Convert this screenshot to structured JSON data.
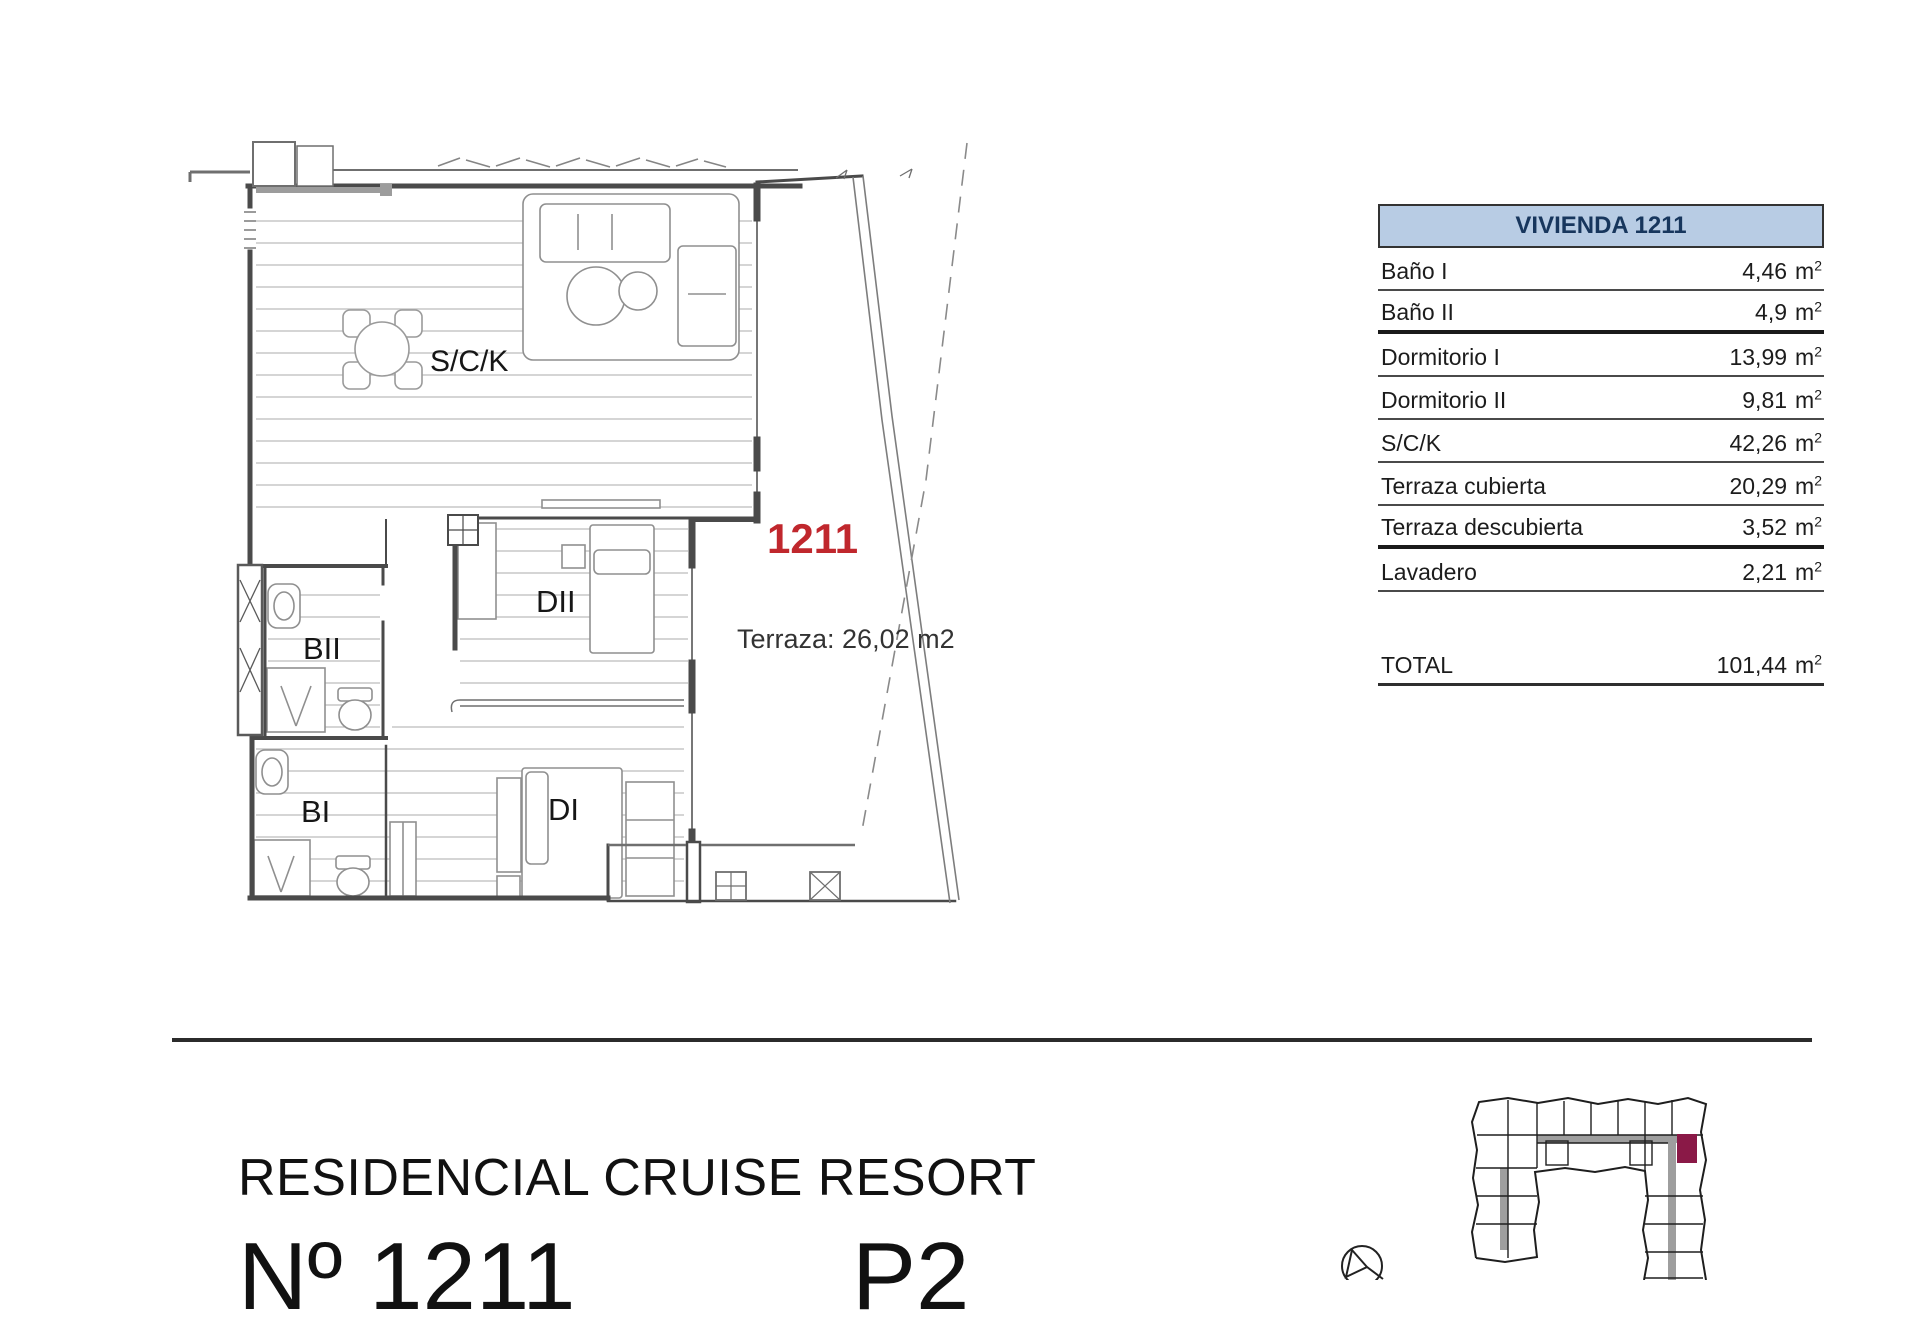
{
  "floor_plan": {
    "unit_number": "1211",
    "terrace_note": "Terraza: 26,02 m2",
    "room_labels": {
      "living": "S/C/K",
      "bedroom2": "DII",
      "bath2": "BII",
      "bath1": "BI",
      "bedroom1": "DI"
    }
  },
  "area_table": {
    "header": "VIVIENDA 1211",
    "rows": [
      {
        "label": "Baño I",
        "value": "4,46",
        "unit": "m",
        "sup": "2"
      },
      {
        "label": "Baño II",
        "value": "4,9",
        "unit": "m",
        "sup": "2"
      },
      {
        "label": "Dormitorio I",
        "value": "13,99",
        "unit": "m",
        "sup": "2"
      },
      {
        "label": "Dormitorio II",
        "value": "9,81",
        "unit": "m",
        "sup": "2"
      },
      {
        "label": "S/C/K",
        "value": "42,26",
        "unit": "m",
        "sup": "2"
      },
      {
        "label": "Terraza cubierta",
        "value": "20,29",
        "unit": "m",
        "sup": "2"
      },
      {
        "label": "Terraza descubierta",
        "value": "3,52",
        "unit": "m",
        "sup": "2"
      },
      {
        "label": "Lavadero",
        "value": "2,21",
        "unit": "m",
        "sup": "2"
      }
    ],
    "total": {
      "label": "TOTAL",
      "value": "101,44",
      "unit": "m",
      "sup": "2"
    }
  },
  "footer": {
    "project_name": "RESIDENCIAL CRUISE RESORT",
    "unit_label": "Nº 1211",
    "floor_label": "P2"
  },
  "colors": {
    "unit_number_red": "#c0272d",
    "table_header_bg": "#b8cce4",
    "table_header_text": "#17365d",
    "highlighted_unit": "#8a1947"
  }
}
